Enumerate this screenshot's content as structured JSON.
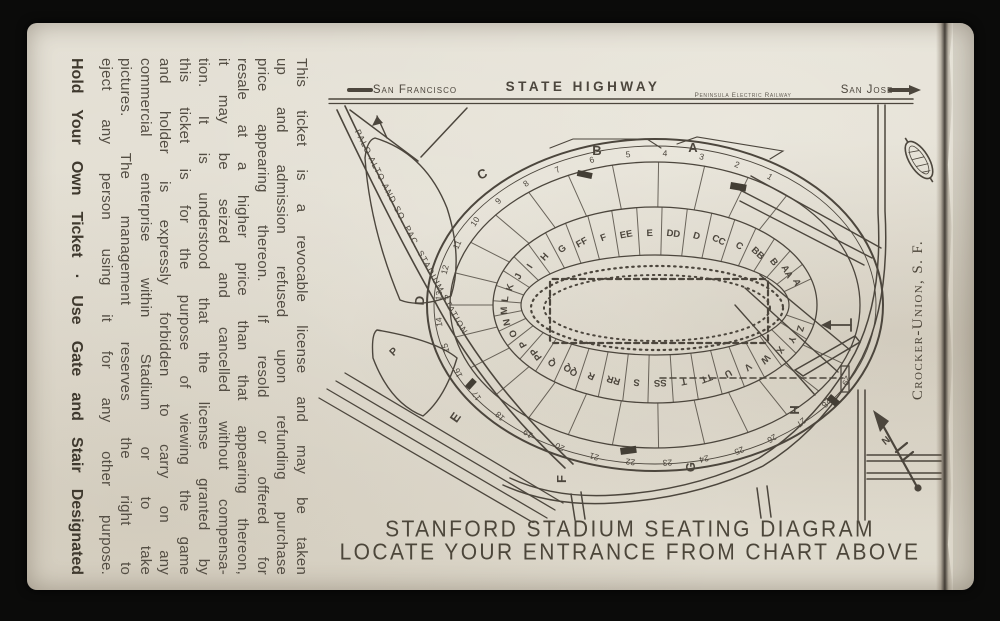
{
  "ticket": {
    "terms_lines": [
      "This ticket is a revocable license and may be taken",
      "up and admission refused upon refunding purchase",
      "price appearing thereon. If resold or offered for",
      "resale at a higher price than that appearing thereon,",
      "it may be seized and cancelled without compensa-",
      "tion. It is understood that the license granted by",
      "this ticket is for the purpose of viewing the game",
      "and holder is expressly forbidden to carry on any",
      "commercial enterprise within Stadium or to take",
      "pictures. The management reserves the right to",
      "eject any person using it for any other purpose."
    ],
    "hold_line": "Hold Your Own Ticket · Use Gate and Stair Designated",
    "printer_credit": "Crocker-Union, S. F.",
    "caption_line1": "STANFORD STADIUM SEATING DIAGRAM",
    "caption_line2": "LOCATE YOUR ENTRANCE FROM CHART ABOVE"
  },
  "map": {
    "highway_left": "San Francisco",
    "highway_center": "STATE HIGHWAY",
    "railway": "Peninsula Electric Railway",
    "highway_right": "San Jose",
    "station_road": "PALO ALTO AND SO. PAC. STADIUM STATION",
    "compass": "N",
    "parking": "P",
    "sections": [
      "A",
      "AA",
      "B",
      "BB",
      "C",
      "CC",
      "D",
      "DD",
      "E",
      "EE",
      "F",
      "FF",
      "G",
      "H",
      "I",
      "J",
      "K",
      "L",
      "M",
      "N",
      "O",
      "P",
      "PP",
      "Q",
      "QQ",
      "R",
      "RR",
      "S",
      "SS",
      "T",
      "TT",
      "U",
      "V",
      "W",
      "X",
      "Y",
      "Z"
    ],
    "gate_letters": [
      "A",
      "B",
      "C",
      "D",
      "E",
      "F",
      "G",
      "H"
    ],
    "gate_numbers": [
      "1",
      "2",
      "3",
      "4",
      "5",
      "6",
      "7",
      "8",
      "9",
      "10",
      "11",
      "12",
      "13",
      "14",
      "15",
      "16",
      "17",
      "18",
      "19",
      "20",
      "21",
      "22",
      "23",
      "24",
      "25",
      "26",
      "27",
      "28",
      "29"
    ]
  },
  "colors": {
    "ink": "#4c463d",
    "paper": "#e3dfd4",
    "background": "#0b0b0a"
  }
}
